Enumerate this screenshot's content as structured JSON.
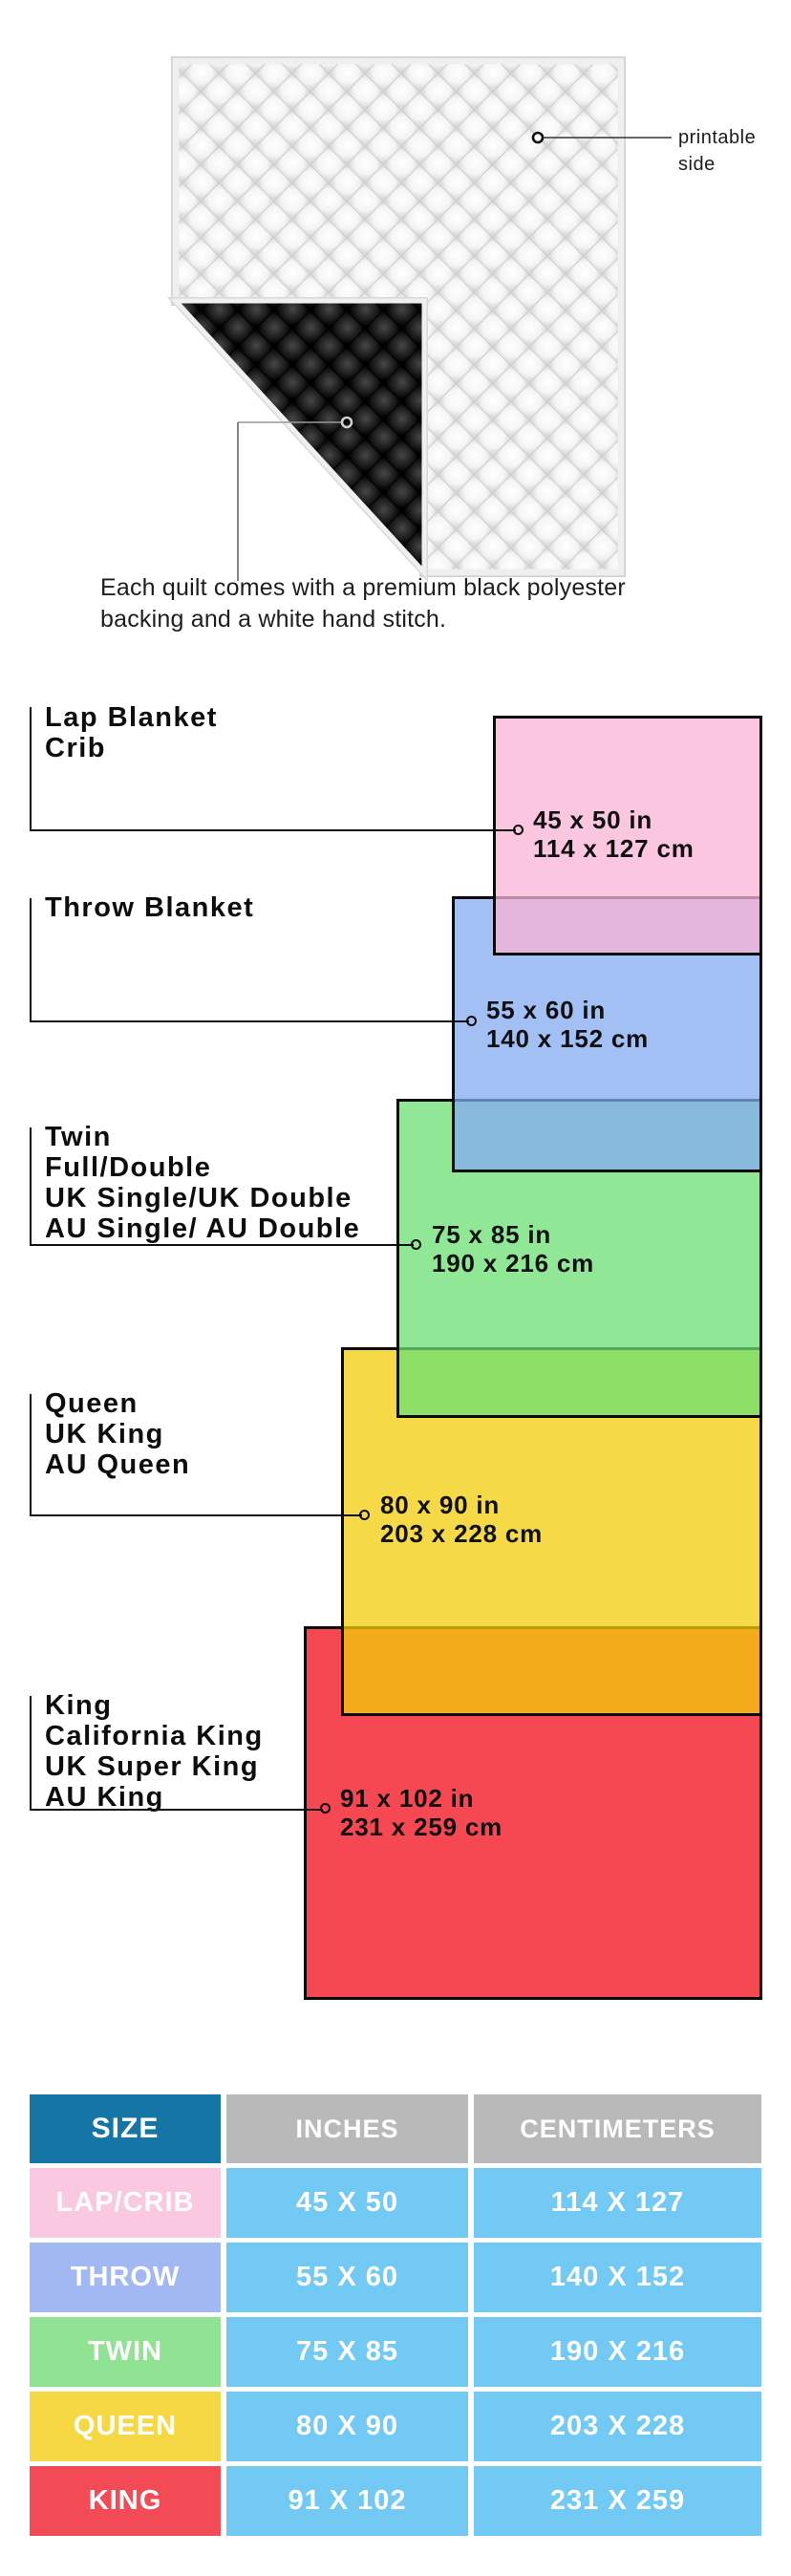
{
  "quilt_section": {
    "printable_label": {
      "line1": "printable",
      "line2": "side"
    },
    "caption_line1": "Each quilt comes with a premium black polyester",
    "caption_line2": "backing and a white hand stitch."
  },
  "diagram": {
    "items": [
      {
        "id": "lap-crib",
        "label_lines": [
          "Lap Blanket",
          "Crib"
        ],
        "size_in": "45 x 50 in",
        "size_cm": "114 x 127 cm",
        "color": "#fac8e1"
      },
      {
        "id": "throw",
        "label_lines": [
          "Throw Blanket"
        ],
        "size_in": "55 x 60 in",
        "size_cm": "140 x 152 cm",
        "color": "#a4c0f6"
      },
      {
        "id": "twin",
        "label_lines": [
          "Twin",
          "Full/Double",
          "UK Single/UK Double",
          "AU Single/ AU Double"
        ],
        "size_in": "75 x 85 in",
        "size_cm": "190 x 216 cm",
        "color": "#90e89a"
      },
      {
        "id": "queen",
        "label_lines": [
          "Queen",
          "UK King",
          "AU Queen"
        ],
        "size_in": "80 x 90 in",
        "size_cm": "203 x 228 cm",
        "color": "#f5d747"
      },
      {
        "id": "king",
        "label_lines": [
          "King",
          "California King",
          "UK Super King",
          "AU King"
        ],
        "size_in": "91 x 102 in",
        "size_cm": "231 x 259 cm",
        "color": "#f54853"
      }
    ]
  },
  "table": {
    "headers": [
      "SIZE",
      "INCHES",
      "CENTIMETERS"
    ],
    "header_colors": {
      "size_bg": "#1575a5",
      "other_bg": "#b9b9b9",
      "cell_bg": "#72c9f3"
    },
    "rows": [
      {
        "size": "LAP/CRIB",
        "inches": "45 X 50",
        "centimeters": "114 X 127",
        "color": "#fac8e1"
      },
      {
        "size": "THROW",
        "inches": "55 X 60",
        "centimeters": "140 X 152",
        "color": "#a2b8f2"
      },
      {
        "size": "TWIN",
        "inches": "75 X 85",
        "centimeters": "190 X 216",
        "color": "#8fe393"
      },
      {
        "size": "QUEEN",
        "inches": "80 X 90",
        "centimeters": "203 X 228",
        "color": "#f6d844"
      },
      {
        "size": "KING",
        "inches": "91 X 102",
        "centimeters": "231 X 259",
        "color": "#f24b56"
      }
    ]
  }
}
